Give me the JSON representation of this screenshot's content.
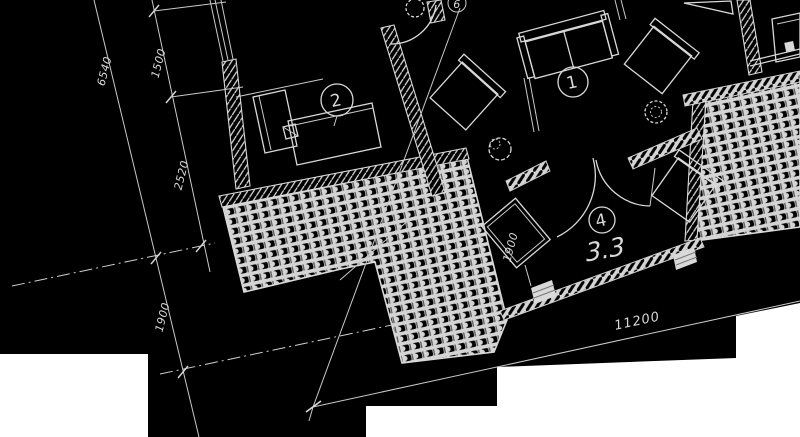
{
  "drawing": {
    "type": "architectural-floor-plan",
    "background_color": "#000000",
    "line_color": "#d9d9d9",
    "cutout_color": "#ffffff",
    "room_label": "3.3",
    "dimensions": {
      "d6540": "6540",
      "d1500": "1500",
      "d2520": "2520",
      "d1900_left": "1900",
      "d1900_room": "1900",
      "d11200": "11200"
    },
    "markers": {
      "m1": "1",
      "m2": "2",
      "m4": "4",
      "m6": "6"
    }
  }
}
